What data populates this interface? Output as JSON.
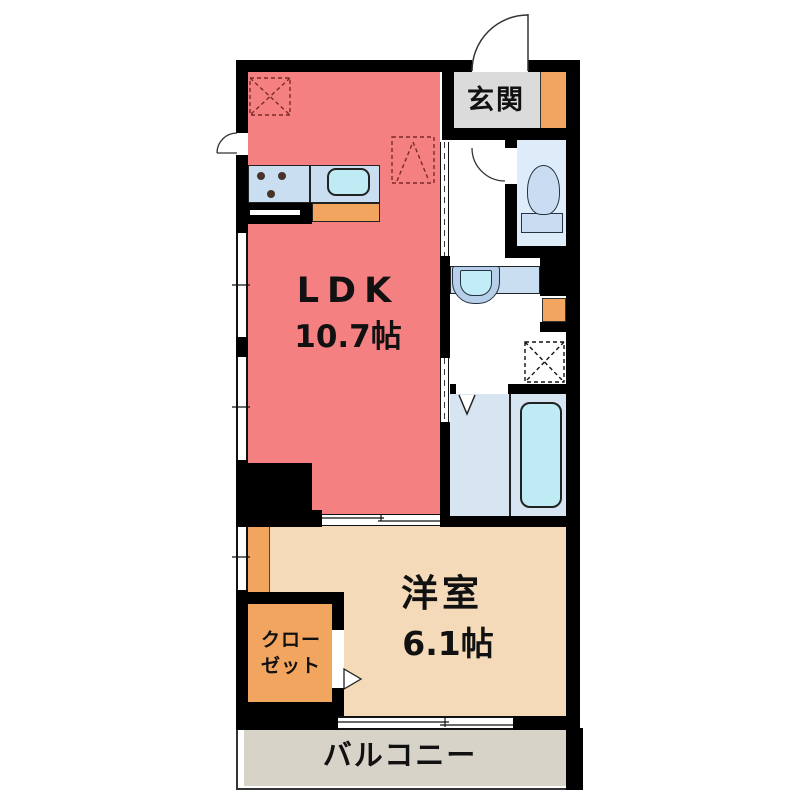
{
  "floor_plan": {
    "rooms": {
      "entrance": {
        "label": "玄関"
      },
      "ldk": {
        "label": "LDK",
        "size": "10.7帖"
      },
      "western_room": {
        "label": "洋室",
        "size": "6.1帖"
      },
      "closet": {
        "label_line1": "クロー",
        "label_line2": "ゼット"
      },
      "balcony": {
        "label": "バルコニー"
      }
    },
    "fixtures": [
      "kitchen-counter",
      "stove-burners",
      "kitchen-sink",
      "refrigerator-space",
      "toilet",
      "washbasin",
      "washing-machine-space",
      "bathtub",
      "entrance-door",
      "back-door",
      "toilet-door",
      "bathroom-folding-door",
      "closet-door",
      "sliding-doors",
      "windows"
    ],
    "colors": {
      "wall": "#000000",
      "ldk_floor": "#F58082",
      "western_floor": "#F4DAB9",
      "closet_floor": "#F2A55E",
      "accent_orange": "#F2A55E",
      "entrance_floor": "#DBDBDB",
      "balcony_floor": "#D7D3C8",
      "toilet_floor": "#DEEBF8",
      "bath_floor": "#D7E4F2",
      "counter_blue": "#C9DFF1",
      "water_cyan": "#BEEBF4",
      "dashed_symbol": "#7a2a2a"
    }
  }
}
